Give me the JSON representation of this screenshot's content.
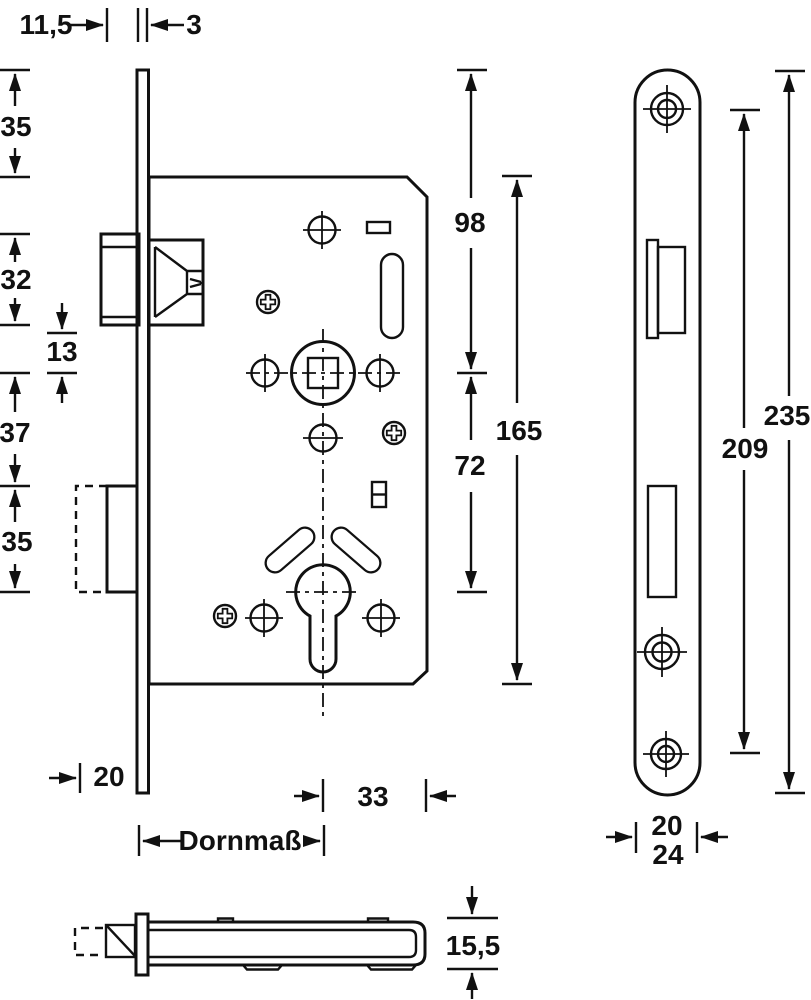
{
  "colors": {
    "ink": "#111111",
    "paper": "#ffffff"
  },
  "dims": {
    "latch_protrusion": "11,5",
    "faceplate_thickness": "3",
    "top_to_case": "35",
    "latch_height": "32",
    "latch_offset": "13",
    "latch_to_deadbolt": "37",
    "deadbolt_height": "35",
    "backset_value": "20",
    "backset_label": "Dornmaß",
    "case_depth": "33",
    "top_to_spindle": "98",
    "case_height": "165",
    "spindle_to_cylinder": "72",
    "screw_spacing": "209",
    "faceplate_length": "235",
    "faceplate_width_narrow": "20",
    "faceplate_width_wide": "24",
    "case_thickness": "15,5"
  }
}
